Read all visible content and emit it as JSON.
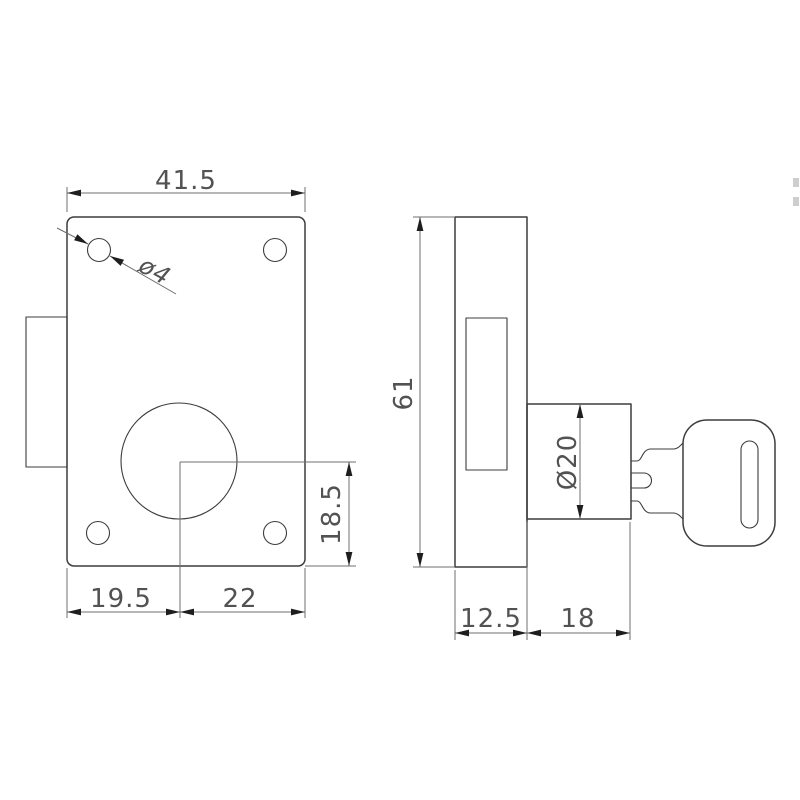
{
  "drawing": {
    "type": "technical-drawing",
    "subject": "rim-lock-two-view",
    "colors": {
      "background": "#ffffff",
      "object_line": "#3d3d3d",
      "dimension_line": "#6f6f6f",
      "arrow": "#1e1e1e",
      "text": "#525252"
    },
    "front_view": {
      "dimensions": {
        "plate_width": "41.5",
        "hole_diameter": "ø4",
        "offset_left": "19.5",
        "offset_right": "22",
        "offset_bottom": "18.5"
      }
    },
    "side_view": {
      "dimensions": {
        "body_height": "61",
        "cylinder_diameter": "Ø20",
        "body_depth": "12.5",
        "cylinder_length": "18"
      }
    }
  }
}
